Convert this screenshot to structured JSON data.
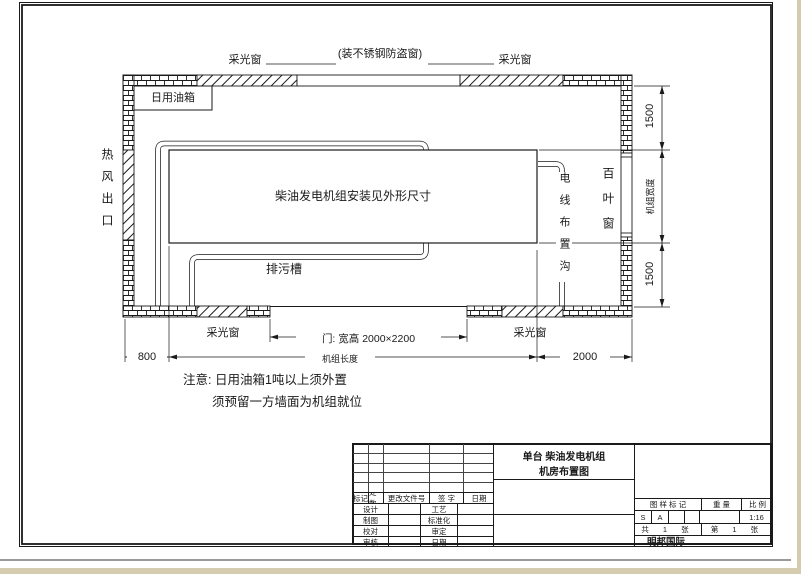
{
  "drawing": {
    "skylight_windows": [
      "采光窗",
      "采光窗",
      "采光窗",
      "采光窗"
    ],
    "labels": {
      "top_window_note": "(装不锈钢防盗窗)",
      "fuel_tank": "日用油箱",
      "hot_air_outlet": "热风出口",
      "generator": "柴油发电机组安装见外形尺寸",
      "drain_trough": "排污槽",
      "cable_trench": "电线布置沟",
      "louver_window": "百叶窗",
      "door": "门: 宽高 2000×2200"
    },
    "dimensions": {
      "right_top": "1500",
      "right_middle": "机组宽度",
      "right_bottom": "1500",
      "bottom_left": "800",
      "bottom_middle": "机组长度",
      "bottom_right": "2000"
    },
    "notes": {
      "line1": "注意: 日用油箱1吨以上须外置",
      "line2": "须预留一方墙面为机组就位"
    }
  },
  "title_block": {
    "title_line1": "单台  柴油发电机组",
    "title_line2": "机房布置图",
    "revision_header": [
      "标记",
      "处数",
      "更改文件号",
      "签 字",
      "日期"
    ],
    "left_labels": {
      "design": "设计",
      "draft": "制图",
      "check": "校对",
      "review": "审核",
      "process": "工艺",
      "standard": "标准化",
      "approve": "审定",
      "date": "日期"
    },
    "stamp_header": {
      "mark": "图 样 标 记",
      "weight": "重 量",
      "scale": "比 例"
    },
    "stamp_values": {
      "s": "S",
      "a": "A",
      "scale": "1:16"
    },
    "sheets": {
      "total": "共 1 张",
      "number": "第 1 张"
    },
    "company": "明邦国际"
  }
}
